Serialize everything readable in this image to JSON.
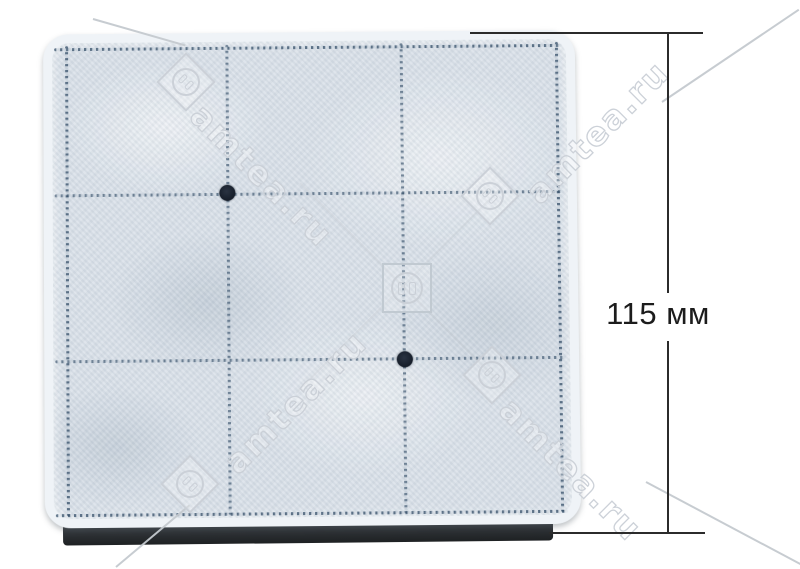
{
  "photo": {
    "dimension": {
      "label": "115 мм"
    },
    "watermark": {
      "text": "amtea.ru",
      "logo_icon": "socket-diamond-icon"
    },
    "filter": {
      "grid_rows": 3,
      "grid_cols": 3,
      "marker_dots": 2
    },
    "colors": {
      "background": "#ffffff",
      "pad": "#dbe2ea",
      "pad_rim": "#eff3f7",
      "stitch": "#44607c",
      "marker_dot": "#161d29",
      "base_strip": "#2e3236",
      "dimension_line": "#2b2b2b",
      "watermark_outline": "#ccd2d8"
    }
  }
}
